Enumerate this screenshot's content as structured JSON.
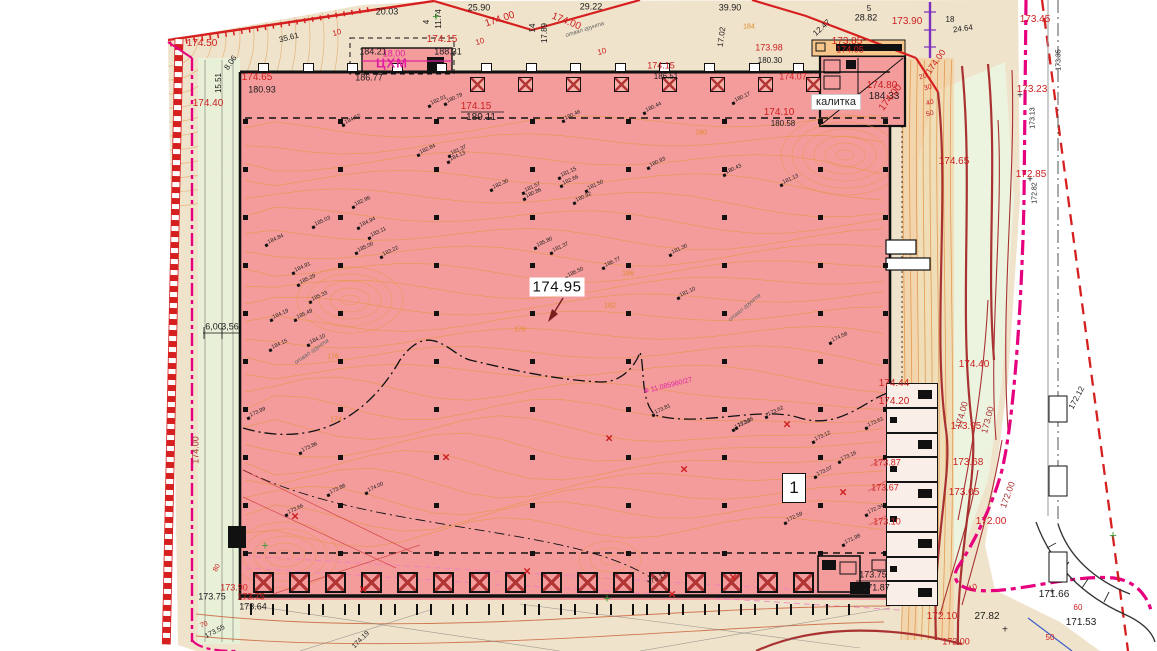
{
  "title": "Site plan / vertical layout drawing",
  "palette": {
    "paper": "#ffffff",
    "ground": "#f0e3cb",
    "building_pink": "#f49c9c",
    "annex_orange": "#f6c68c",
    "green_light": "#e8f0d8",
    "green_right": "#ecf4e0",
    "rooms_fill": "#faeee8",
    "contour_orange": "#e6953f",
    "band_tint": "#f4c488",
    "red_line": "#d62020",
    "dark_red": "#a83232",
    "magenta": "#e6007e",
    "magenta_text": "#e020a0",
    "violet": "#7b2fbe",
    "black": "#1a1a1a",
    "gray_road": "#9a9a9a",
    "label_red": "#cc2020",
    "label_orange": "#e08a2a",
    "green_marker": "#3f9a35",
    "blue": "#3a5fc8"
  },
  "main_labels": {
    "center_elevation": "174.95",
    "area_number": "1",
    "gate_label": "калитка",
    "block_label": "ЦХМ"
  },
  "labels": [
    [
      "25.90",
      479,
      8,
      "k",
      9,
      0
    ],
    [
      "29.22",
      591,
      7,
      "k",
      9,
      0
    ],
    [
      "39.90",
      730,
      8,
      "k",
      9,
      0
    ],
    [
      "20.03",
      387,
      12,
      "k",
      9,
      0
    ],
    [
      "35.61",
      289,
      38,
      "k",
      8,
      -14
    ],
    [
      "11.74",
      439,
      19,
      "k",
      8,
      -90
    ],
    [
      "4",
      427,
      22,
      "k",
      8,
      -90
    ],
    [
      "14",
      533,
      28,
      "k",
      8,
      -90
    ],
    [
      "17.89",
      545,
      33,
      "k",
      8,
      -90
    ],
    [
      "17.02",
      722,
      37,
      "k",
      8,
      -82
    ],
    [
      "5",
      869,
      9,
      "k",
      8,
      0
    ],
    [
      "28.82",
      866,
      18,
      "k",
      9,
      0
    ],
    [
      "12.47",
      822,
      28,
      "k",
      8,
      -42
    ],
    [
      "18",
      950,
      20,
      "k",
      8,
      0
    ],
    [
      "24.64",
      963,
      29,
      "k",
      8,
      -8
    ],
    [
      "8.06",
      231,
      63,
      "k",
      8,
      -55
    ],
    [
      "15.51",
      219,
      83,
      "k",
      8,
      -90
    ],
    [
      "184.21",
      373,
      52,
      "k",
      9,
      0
    ],
    [
      "188.31",
      448,
      52,
      "k",
      9,
      0
    ],
    [
      "186.77",
      369,
      78,
      "k",
      9,
      0
    ],
    [
      "180.93",
      262,
      90,
      "k",
      9,
      0
    ],
    [
      "189.11",
      481,
      118,
      "k",
      10,
      0
    ],
    [
      "180.58",
      783,
      124,
      "k",
      8,
      0
    ],
    [
      "180.30",
      770,
      61,
      "k",
      8,
      0
    ],
    [
      "184.33",
      884,
      97,
      "k",
      10,
      0
    ],
    [
      "6,00",
      214,
      327,
      "k",
      9,
      0
    ],
    [
      "3,56",
      230,
      327,
      "k",
      9,
      0
    ],
    [
      "173.75",
      873,
      575,
      "k",
      9,
      0
    ],
    [
      "171.87",
      876,
      588,
      "k",
      9,
      0
    ],
    [
      "27.82",
      987,
      617,
      "k",
      10,
      0
    ],
    [
      "171.66",
      1054,
      595,
      "k",
      10,
      0
    ],
    [
      "171.53",
      1081,
      623,
      "k",
      10,
      0
    ],
    [
      "173.75",
      212,
      597,
      "k",
      9,
      0
    ],
    [
      "173.64",
      253,
      607,
      "k",
      9,
      0
    ],
    [
      "173.55",
      215,
      632,
      "k",
      7,
      -28
    ],
    [
      "173.17",
      657,
      579,
      "k",
      7,
      -30
    ],
    [
      "174.19",
      361,
      640,
      "k",
      7,
      -45
    ],
    [
      "172.12",
      1077,
      398,
      "k",
      8,
      -62
    ],
    [
      "173.13",
      1033,
      118,
      "k",
      7,
      -90
    ],
    [
      "172.82",
      1035,
      193,
      "k",
      7,
      -90
    ],
    [
      "173.35",
      1059,
      60,
      "k",
      7,
      -90
    ],
    [
      "186.51",
      666,
      77,
      "k",
      8,
      0
    ],
    [
      "174.50",
      202,
      44,
      "r",
      10,
      0
    ],
    [
      "174.00",
      500,
      20,
      "r",
      10,
      -18
    ],
    [
      "174.00",
      566,
      22,
      "r",
      10,
      22
    ],
    [
      "174.00",
      891,
      98,
      "r",
      10,
      -52
    ],
    [
      "174.00",
      936,
      62,
      "r",
      9,
      -55
    ],
    [
      "173.90",
      907,
      22,
      "r",
      10,
      0
    ],
    [
      "173.85",
      847,
      42,
      "r",
      10,
      0
    ],
    [
      "174.05",
      850,
      50,
      "r",
      9,
      0
    ],
    [
      "173.98",
      769,
      48,
      "r",
      9,
      0
    ],
    [
      "174.15",
      442,
      40,
      "r",
      10,
      0
    ],
    [
      "174.15",
      661,
      66,
      "r",
      9,
      0
    ],
    [
      "174.65",
      257,
      78,
      "r",
      10,
      0
    ],
    [
      "174.40",
      208,
      104,
      "r",
      10,
      0
    ],
    [
      "174.15",
      476,
      107,
      "r",
      10,
      0
    ],
    [
      "174.10",
      779,
      113,
      "r",
      10,
      0
    ],
    [
      "174.07",
      793,
      77,
      "r",
      9,
      0
    ],
    [
      "174.80",
      882,
      86,
      "r",
      10,
      0
    ],
    [
      "173.45",
      1035,
      20,
      "r",
      10,
      0
    ],
    [
      "173.23",
      1032,
      90,
      "r",
      10,
      0
    ],
    [
      "172.85",
      1031,
      175,
      "r",
      10,
      0
    ],
    [
      "174.65",
      954,
      162,
      "r",
      10,
      0
    ],
    [
      "174.44",
      894,
      384,
      "r",
      10,
      0
    ],
    [
      "174.20",
      894,
      402,
      "r",
      10,
      0
    ],
    [
      "174.40",
      974,
      365,
      "r",
      10,
      0
    ],
    [
      "173.95",
      966,
      427,
      "r",
      10,
      0
    ],
    [
      "173.68",
      968,
      463,
      "r",
      10,
      0
    ],
    [
      "173.05",
      964,
      493,
      "r",
      10,
      0
    ],
    [
      "172.00",
      991,
      522,
      "r",
      10,
      0
    ],
    [
      "172.10",
      942,
      617,
      "r",
      10,
      0
    ],
    [
      "172.00",
      956,
      642,
      "r",
      9,
      0
    ],
    [
      "173.87",
      887,
      463,
      "r",
      9,
      0
    ],
    [
      "173.67",
      885,
      488,
      "r",
      9,
      0
    ],
    [
      "173.10",
      887,
      522,
      "r",
      9,
      0
    ],
    [
      "173.90",
      234,
      588,
      "r",
      9,
      0
    ],
    [
      "173.75",
      251,
      597,
      "r",
      9,
      0
    ],
    [
      "20",
      923,
      77,
      "r",
      7,
      -15
    ],
    [
      "30",
      928,
      88,
      "r",
      7,
      -15
    ],
    [
      "40",
      930,
      103,
      "r",
      7,
      -15
    ],
    [
      "50",
      930,
      114,
      "r",
      7,
      -15
    ],
    [
      "80",
      217,
      568,
      "r",
      7,
      -60
    ],
    [
      "70",
      204,
      625,
      "r",
      7,
      -20
    ],
    [
      "60",
      1078,
      608,
      "r",
      8,
      0
    ],
    [
      "50",
      1050,
      638,
      "r",
      8,
      0
    ],
    [
      "10",
      337,
      33,
      "r",
      8,
      -15
    ],
    [
      "10",
      480,
      42,
      "r",
      8,
      -15
    ],
    [
      "10",
      602,
      52,
      "r",
      8,
      -15
    ],
    [
      "10",
      973,
      588,
      "r",
      8,
      -20
    ],
    [
      "174.00",
      962,
      415,
      "dr",
      9,
      -75
    ],
    [
      "173.00",
      988,
      420,
      "dr",
      9,
      -75
    ],
    [
      "172.00",
      1008,
      495,
      "dr",
      9,
      -70
    ],
    [
      "174.00",
      196,
      450,
      "dr",
      9,
      -90
    ],
    [
      "18,00",
      394,
      54,
      "m",
      9,
      0
    ],
    [
      "Ф 11.085960/27",
      668,
      386,
      "m",
      7,
      -14
    ],
    [
      "186",
      628,
      274,
      "o",
      7,
      0
    ],
    [
      "182",
      610,
      306,
      "o",
      7,
      0
    ],
    [
      "180",
      701,
      133,
      "o",
      7,
      0
    ],
    [
      "184",
      749,
      27,
      "o",
      7,
      0
    ],
    [
      "178",
      520,
      330,
      "o",
      7,
      0
    ],
    [
      "176",
      333,
      357,
      "o",
      7,
      0
    ],
    [
      "174",
      336,
      420,
      "o",
      7,
      0
    ],
    [
      "отвал грунта",
      312,
      352,
      "i",
      6,
      -35
    ],
    [
      "отвал грунта",
      585,
      30,
      "i",
      6,
      -18
    ],
    [
      "отвал грунта",
      745,
      308,
      "i",
      6,
      -40
    ]
  ],
  "spot_elevations": [
    [
      447,
      99,
      "180.79"
    ],
    [
      431,
      101,
      "182.01"
    ],
    [
      565,
      116,
      "180.46"
    ],
    [
      646,
      108,
      "180.44"
    ],
    [
      735,
      98,
      "180.17"
    ],
    [
      650,
      163,
      "180.93"
    ],
    [
      726,
      170,
      "180.43"
    ],
    [
      561,
      173,
      "181.15"
    ],
    [
      563,
      181,
      "182.66"
    ],
    [
      588,
      186,
      "181.50"
    ],
    [
      451,
      151,
      "181.37"
    ],
    [
      450,
      157,
      "184.13"
    ],
    [
      493,
      185,
      "182.30"
    ],
    [
      525,
      188,
      "181.57"
    ],
    [
      526,
      194,
      "180.86"
    ],
    [
      783,
      180,
      "181.13"
    ],
    [
      576,
      198,
      "180.92"
    ],
    [
      315,
      222,
      "185.03"
    ],
    [
      268,
      240,
      "184.84"
    ],
    [
      360,
      223,
      "184.94"
    ],
    [
      371,
      233,
      "183.11"
    ],
    [
      358,
      248,
      "185.00"
    ],
    [
      383,
      252,
      "183.22"
    ],
    [
      355,
      202,
      "182.96"
    ],
    [
      295,
      268,
      "184.91"
    ],
    [
      300,
      280,
      "185.29"
    ],
    [
      312,
      297,
      "185.33"
    ],
    [
      273,
      315,
      "184.19"
    ],
    [
      297,
      315,
      "185.49"
    ],
    [
      310,
      340,
      "184.10"
    ],
    [
      272,
      345,
      "184.15"
    ],
    [
      605,
      263,
      "186.77"
    ],
    [
      568,
      273,
      "186.50"
    ],
    [
      672,
      250,
      "181.30"
    ],
    [
      680,
      293,
      "181.10"
    ],
    [
      553,
      248,
      "181.37"
    ],
    [
      655,
      410,
      "173.81"
    ],
    [
      768,
      412,
      "173.62"
    ],
    [
      738,
      423,
      "173.36"
    ],
    [
      815,
      437,
      "173.12"
    ],
    [
      868,
      423,
      "173.61"
    ],
    [
      832,
      338,
      "174.58"
    ],
    [
      735,
      425,
      "173.38"
    ],
    [
      841,
      457,
      "173.16"
    ],
    [
      817,
      472,
      "173.07"
    ],
    [
      787,
      518,
      "172.59"
    ],
    [
      845,
      540,
      "171.98"
    ],
    [
      868,
      510,
      "172.34"
    ],
    [
      250,
      413,
      "173.99"
    ],
    [
      302,
      448,
      "173.86"
    ],
    [
      330,
      490,
      "173.88"
    ],
    [
      288,
      510,
      "173.66"
    ],
    [
      368,
      488,
      "174.00"
    ],
    [
      537,
      243,
      "185.80"
    ],
    [
      345,
      120,
      "184.62"
    ],
    [
      420,
      150,
      "182.84"
    ]
  ],
  "markers": {
    "red_x": [
      [
        295,
        516
      ],
      [
        363,
        589
      ],
      [
        446,
        457
      ],
      [
        527,
        571
      ],
      [
        609,
        438
      ],
      [
        684,
        469
      ],
      [
        787,
        424
      ],
      [
        843,
        492
      ],
      [
        733,
        577
      ],
      [
        672,
        594
      ]
    ],
    "green_plus": [
      [
        265,
        545
      ],
      [
        607,
        598
      ],
      [
        436,
        16
      ],
      [
        1113,
        535
      ]
    ],
    "black_plus": [
      [
        1020,
        96
      ],
      [
        1030,
        180
      ],
      [
        1005,
        630
      ],
      [
        1052,
        592
      ]
    ]
  },
  "structures": {
    "grid": {
      "cols": [
        245,
        340,
        436,
        532,
        628,
        724,
        820,
        885
      ],
      "rows": [
        121,
        169,
        217,
        265,
        313,
        361,
        409,
        457,
        505,
        553
      ],
      "size": 5
    },
    "top_ticks": {
      "y": 63,
      "x0": 258,
      "dx": 44.6,
      "n": 13,
      "w": 9,
      "h": 7
    },
    "top_hatch": {
      "y": 77,
      "x0": 470,
      "dx": 48,
      "n": 8,
      "s": 13
    },
    "docks": {
      "y": 572,
      "x0": 253,
      "dx": 36,
      "n": 16,
      "s": 17
    },
    "bays": {
      "y": 604,
      "x0": 250,
      "dx": 36,
      "n": 17,
      "w": 20,
      "h": 11
    },
    "rooms": {
      "x": 886,
      "w": 52,
      "y0": 383,
      "dh": 24.8,
      "n": 9
    }
  }
}
